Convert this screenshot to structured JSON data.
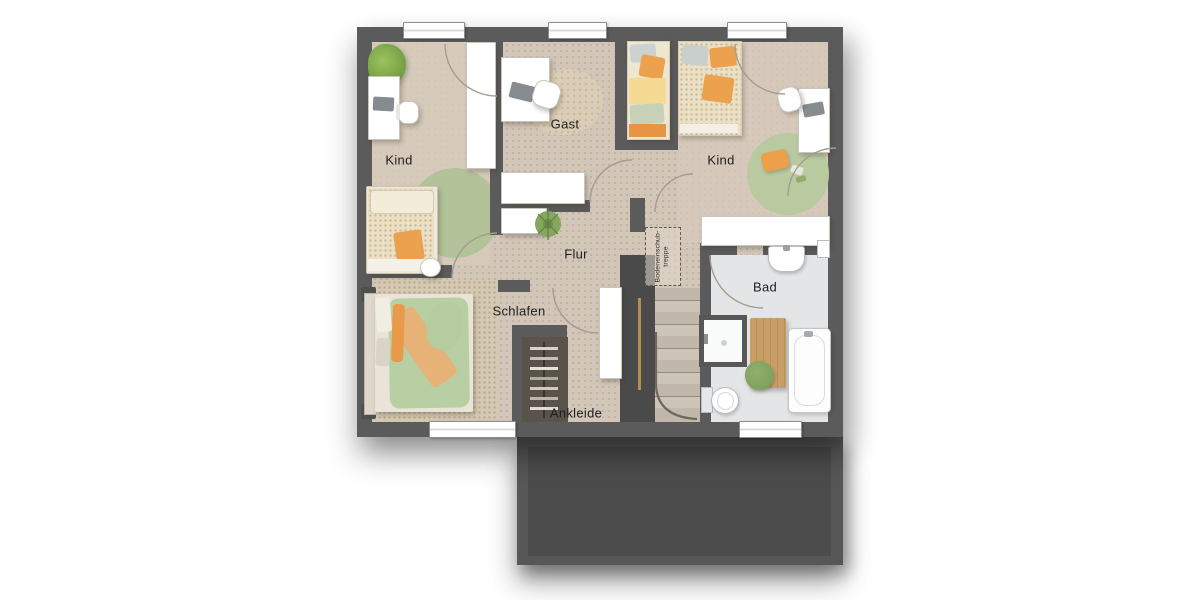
{
  "plan": {
    "rooms": [
      {
        "id": "kind-left",
        "label": "Kind"
      },
      {
        "id": "gast",
        "label": "Gast"
      },
      {
        "id": "kind-right",
        "label": "Kind"
      },
      {
        "id": "flur",
        "label": "Flur"
      },
      {
        "id": "schlafen",
        "label": "Schlafen"
      },
      {
        "id": "ankleide",
        "label": "Ankleide"
      },
      {
        "id": "bad",
        "label": "Bad"
      }
    ],
    "annotations": [
      {
        "id": "loft-hatch",
        "label": "Bodeneinschub-\ntreppe"
      }
    ],
    "colors": {
      "canvas": "#ffffff",
      "wall": "#5b5b5b",
      "wall_dark": "#4a4a4a",
      "floor": "#d2c6b9",
      "floor_warm": "#d7cabc",
      "bad_floor": "#e4e5e7",
      "rug_green": "#b3c299",
      "rug_green2": "#b9c9a0",
      "accent_orange": "#eba14e",
      "duvet_green": "#b8cfa4",
      "duvet_cream": "#ece0c4",
      "gast_yellow": "#f4da92",
      "wood": "#c89f67",
      "stair_tread": "#ccc4b7",
      "stair_tread2": "#c1b8ab",
      "closet_dark": "#59534b",
      "plant_green": "#7ca05c",
      "roof": "#575757",
      "roof_inner": "#4c4c4c",
      "label_color": "#1e1e1e"
    }
  }
}
